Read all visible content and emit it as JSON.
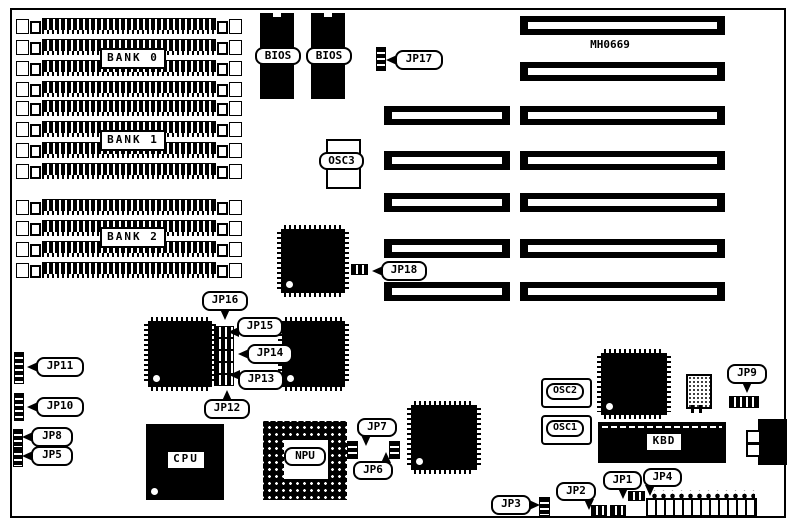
{
  "board": {
    "model": "MH0669"
  },
  "memory": {
    "bank0": "BANK 0",
    "bank1": "BANK 1",
    "bank2": "BANK 2"
  },
  "chips": {
    "bios_left": "BIOS",
    "bios_right": "BIOS",
    "cpu": "CPU",
    "npu": "NPU",
    "kbd": "KBD"
  },
  "oscillators": {
    "osc1": "OSC1",
    "osc2": "OSC2",
    "osc3": "OSC3"
  },
  "jumpers": {
    "jp1": "JP1",
    "jp2": "JP2",
    "jp3": "JP3",
    "jp4": "JP4",
    "jp5": "JP5",
    "jp6": "JP6",
    "jp7": "JP7",
    "jp8": "JP8",
    "jp9": "JP9",
    "jp10": "JP10",
    "jp11": "JP11",
    "jp12": "JP12",
    "jp13": "JP13",
    "jp14": "JP14",
    "jp15": "JP15",
    "jp16": "JP16",
    "jp17": "JP17",
    "jp18": "JP18"
  },
  "colors": {
    "ink": "#000000",
    "paper": "#ffffff"
  }
}
